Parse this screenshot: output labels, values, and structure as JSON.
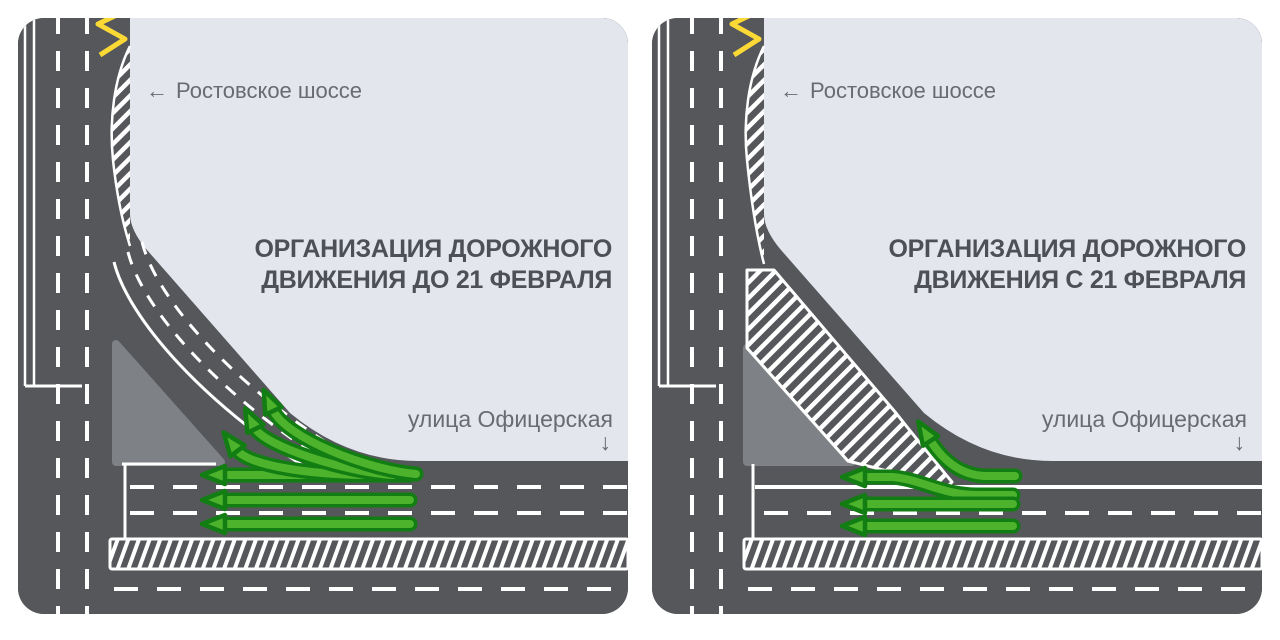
{
  "page": {
    "background": "#ffffff"
  },
  "colors": {
    "road": "#55575b",
    "traffic_island": "#7e8185",
    "area_background": "#e3e6ed",
    "lane_marking": "#ffffff",
    "bus_stop_zigzag": "#fcd935",
    "arrow_fill": "#4db32d",
    "arrow_outline": "#127d12",
    "label_text": "#686c72",
    "title_text": "#4d5055"
  },
  "icons": {
    "left_arrow": "←",
    "down_arrow": "↓"
  },
  "panels": [
    {
      "title_line1": "ОРГАНИЗАЦИЯ ДОРОЖНОГО",
      "title_line2": "ДВИЖЕНИЯ ДО 21 ФЕВРАЛЯ",
      "highway_label": "Ростовское шоссе",
      "street_label": "улица Офицерская"
    },
    {
      "title_line1": "ОРГАНИЗАЦИЯ ДОРОЖНОГО",
      "title_line2": "ДВИЖЕНИЯ С 21 ФЕВРАЛЯ",
      "highway_label": "Ростовское шоссе",
      "street_label": "улица Офицерская"
    }
  ]
}
